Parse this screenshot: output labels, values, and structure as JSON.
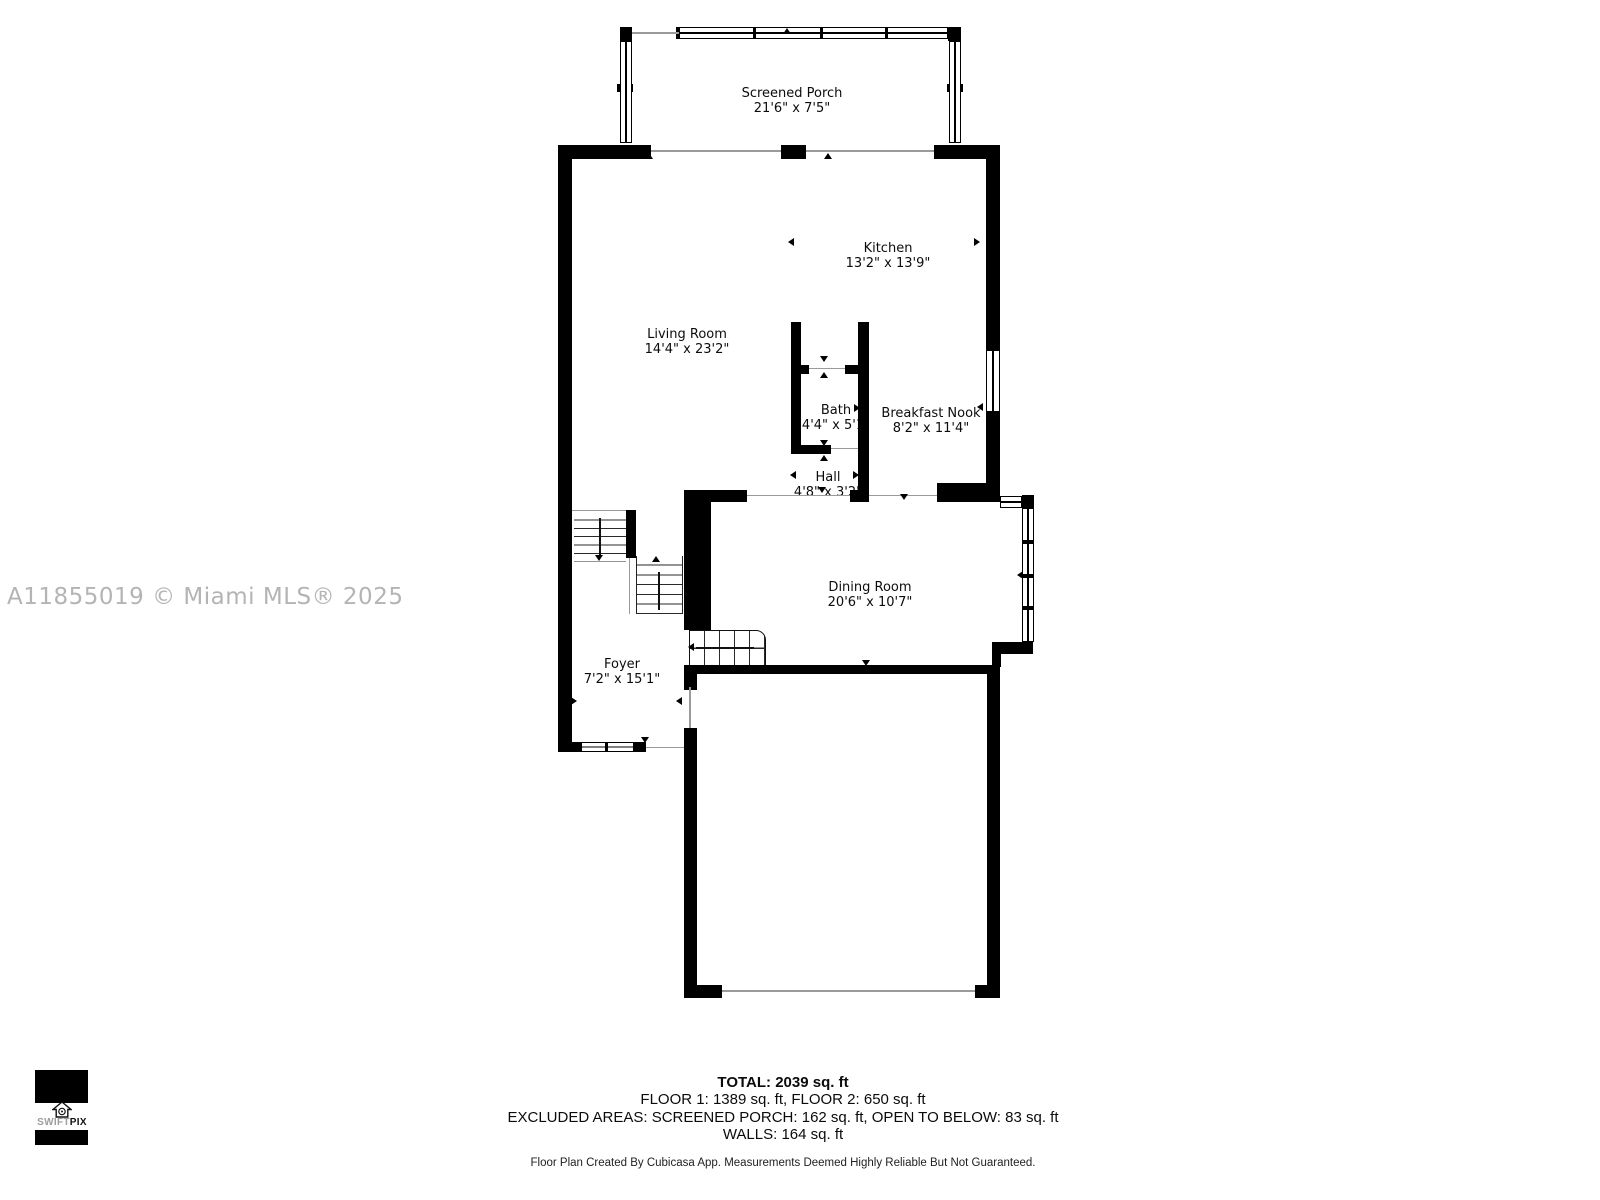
{
  "watermark": "A11855019 © Miami MLS® 2025",
  "rooms": {
    "screened_porch": {
      "name": "Screened Porch",
      "dims": "21'6\" x 7'5\""
    },
    "kitchen": {
      "name": "Kitchen",
      "dims": "13'2\" x 13'9\""
    },
    "living_room": {
      "name": "Living Room",
      "dims": "14'4\" x 23'2\""
    },
    "bath": {
      "name": "Bath",
      "dims": "4'4\" x 5'1\""
    },
    "breakfast_nook": {
      "name": "Breakfast Nook",
      "dims": "8'2\" x 11'4\""
    },
    "hall": {
      "name": "Hall",
      "dims": "4'8\" x 3'2\""
    },
    "dining_room": {
      "name": "Dining Room",
      "dims": "20'6\" x 10'7\""
    },
    "foyer": {
      "name": "Foyer",
      "dims": "7'2\" x 15'1\""
    }
  },
  "summary": {
    "total": "TOTAL: 2039 sq. ft",
    "floors": "FLOOR 1: 1389 sq. ft, FLOOR 2: 650 sq. ft",
    "excluded": "EXCLUDED AREAS: SCREENED PORCH: 162 sq. ft, OPEN TO BELOW: 83 sq. ft",
    "walls": "WALLS: 164 sq. ft"
  },
  "footer": "Floor Plan Created By Cubicasa App. Measurements Deemed Highly Reliable But Not Guaranteed.",
  "logo": {
    "swift": "SWIFT",
    "pix": "PIX"
  },
  "colors": {
    "wall": "#000000",
    "watermark": "#b4b4b4",
    "background": "#ffffff"
  }
}
